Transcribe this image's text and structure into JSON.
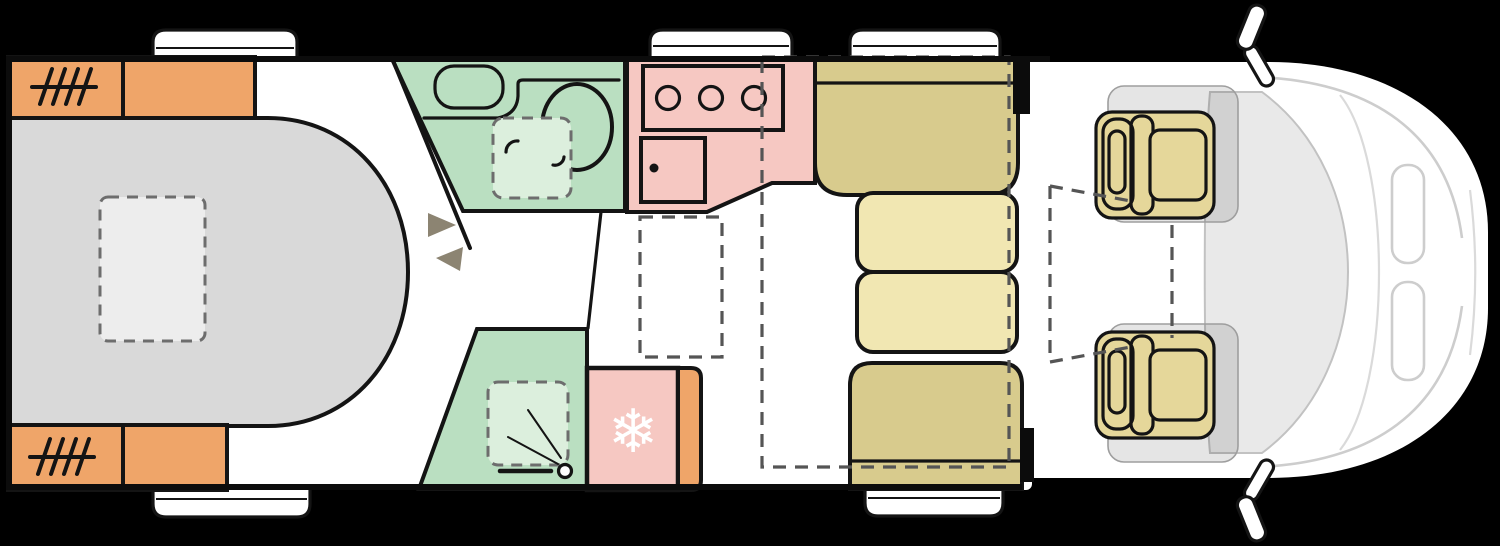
{
  "diagram": {
    "type": "motorhome-floorplan-top-view",
    "canvas": {
      "width": 1500,
      "height": 546,
      "background": "#000000"
    },
    "colors": {
      "body": "#ffffff",
      "outline": "#141414",
      "bed": "#d9d9d9",
      "bed_skylight": "#ededed",
      "wardrobe": "#efa569",
      "bathroom": "#badfc1",
      "shower_tray": "#dcefdd",
      "kitchen": "#f6c8c2",
      "fridge": "#f6c8c2",
      "dinette_bench": "#d8cb8d",
      "dinette_table": "#f1e7b2",
      "cab_seat": "#e5d79a",
      "windshield": "#e9e9e9",
      "snowflake": "#ffffff",
      "step_arrow": "#8c8472",
      "dash_line": "#555555"
    },
    "rooms": [
      {
        "name": "rear-island-bed"
      },
      {
        "name": "wardrobes"
      },
      {
        "name": "washroom-toilet"
      },
      {
        "name": "shower"
      },
      {
        "name": "kitchen"
      },
      {
        "name": "fridge"
      },
      {
        "name": "dinette-lounge"
      },
      {
        "name": "drop-down-bed-zone"
      },
      {
        "name": "cab-swivel-seats"
      }
    ],
    "symbols": {
      "snowflake": "❄",
      "hob_burners": 3,
      "wardrobe_hanger_strokes": 4
    }
  }
}
